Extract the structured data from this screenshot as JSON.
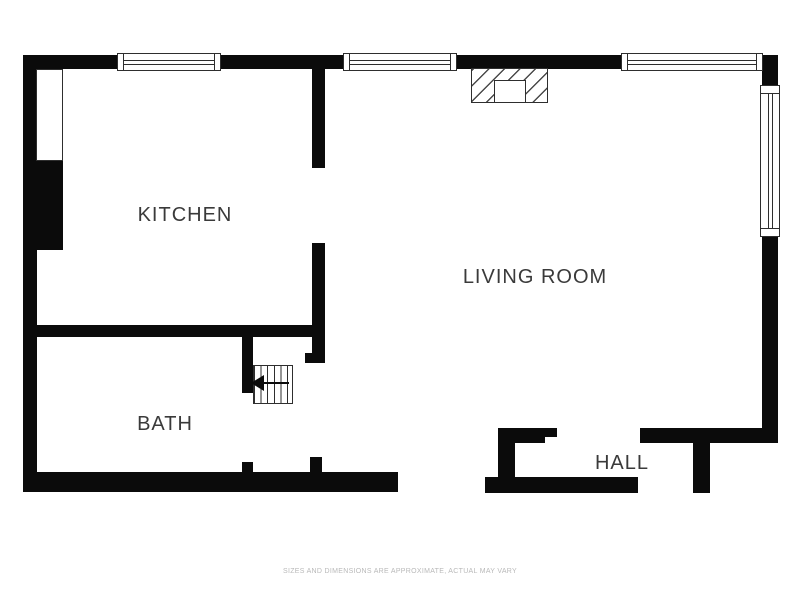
{
  "floorplan": {
    "rooms": [
      {
        "id": "kitchen",
        "label": "KITCHEN"
      },
      {
        "id": "living-room",
        "label": "LIVING ROOM"
      },
      {
        "id": "bath",
        "label": "BATH"
      },
      {
        "id": "hall",
        "label": "HALL"
      }
    ],
    "disclaimer": "SIZES AND DIMENSIONS ARE APPROXIMATE, ACTUAL MAY VARY",
    "stairs_direction": "left",
    "colors": {
      "wall": "#0b0b0b",
      "line": "#2e2e2e",
      "label": "#3a3a3a",
      "disclaimer": "#b9b9b9"
    }
  }
}
